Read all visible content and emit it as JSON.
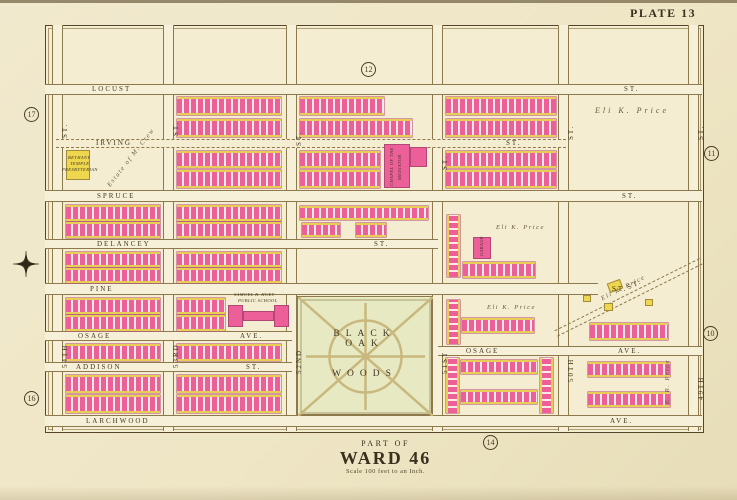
{
  "plate": {
    "label": "PLATE 13"
  },
  "caption": {
    "line1": "PART OF",
    "line2": "WARD 46",
    "line3": "Scale 100 feet to an Inch."
  },
  "colors": {
    "paper": "#efe7c8",
    "brick_pink": "#ec5f98",
    "frame_yellow": "#eed64f",
    "park_green": "#e7e9c3",
    "ink": "#4a3c22"
  },
  "map": {
    "park": {
      "label1": "BLACK OAK",
      "label2": "WOODS"
    },
    "v_streets": [
      {
        "name": "54th",
        "x": 52,
        "y1": 25,
        "y2": 431,
        "labels": [
          {
            "t": "ST.",
            "y": 138
          },
          {
            "t": "54TH",
            "y": 368
          }
        ]
      },
      {
        "name": "53rd",
        "x": 163,
        "y1": 25,
        "y2": 431,
        "labels": [
          {
            "t": "ST.",
            "y": 136
          },
          {
            "t": "53RD",
            "y": 368
          }
        ]
      },
      {
        "name": "52nd",
        "x": 286,
        "y1": 25,
        "y2": 431,
        "labels": [
          {
            "t": "ST.",
            "y": 146
          },
          {
            "t": "52ND",
            "y": 374
          }
        ]
      },
      {
        "name": "51st",
        "x": 432,
        "y1": 25,
        "y2": 431,
        "labels": [
          {
            "t": "ST.",
            "y": 170
          },
          {
            "t": "51ST",
            "y": 374
          }
        ]
      },
      {
        "name": "50th",
        "x": 558,
        "y1": 25,
        "y2": 431,
        "labels": [
          {
            "t": "ST.",
            "y": 140
          },
          {
            "t": "50TH",
            "y": 382
          }
        ]
      },
      {
        "name": "49th",
        "x": 688,
        "y1": 25,
        "y2": 431,
        "labels": [
          {
            "t": "ST.",
            "y": 140
          },
          {
            "t": "49TH",
            "y": 400
          }
        ]
      }
    ],
    "h_streets": [
      {
        "name": "locust",
        "y": 84,
        "h": 11,
        "x1": 45,
        "x2": 702,
        "labels": [
          {
            "t": "LOCUST",
            "x": 92
          },
          {
            "t": "ST.",
            "x": 624
          }
        ]
      },
      {
        "name": "irving",
        "y": 139,
        "h": 9,
        "x1": 56,
        "x2": 566,
        "dashed": true,
        "labels": [
          {
            "t": "IRVING",
            "x": 96
          },
          {
            "t": "ST.",
            "x": 506
          }
        ]
      },
      {
        "name": "spruce",
        "y": 190,
        "h": 12,
        "x1": 45,
        "x2": 702,
        "labels": [
          {
            "t": "SPRUCE",
            "x": 97
          },
          {
            "t": "ST.",
            "x": 622
          }
        ]
      },
      {
        "name": "delancey",
        "y": 239,
        "h": 10,
        "x1": 45,
        "x2": 438,
        "labels": [
          {
            "t": "DELANCEY",
            "x": 97
          },
          {
            "t": "ST.",
            "x": 374
          }
        ]
      },
      {
        "name": "pine",
        "y": 283,
        "h": 12,
        "x1": 45,
        "x2": 598,
        "labels": [
          {
            "t": "PINE",
            "x": 90
          },
          {
            "t": "ST.",
            "x": 612
          }
        ]
      },
      {
        "name": "osage-west",
        "y": 331,
        "h": 10,
        "x1": 45,
        "x2": 292,
        "labels": [
          {
            "t": "OSAGE",
            "x": 78
          },
          {
            "t": "AVE.",
            "x": 240
          }
        ]
      },
      {
        "name": "addison",
        "y": 362,
        "h": 10,
        "x1": 45,
        "x2": 292,
        "labels": [
          {
            "t": "ADDISON",
            "x": 76
          },
          {
            "t": "ST.",
            "x": 246
          }
        ]
      },
      {
        "name": "osage-east",
        "y": 346,
        "h": 10,
        "x1": 438,
        "x2": 702,
        "labels": [
          {
            "t": "OSAGE",
            "x": 466
          },
          {
            "t": "AVE.",
            "x": 618
          }
        ]
      },
      {
        "name": "larchwood",
        "y": 415,
        "h": 12,
        "x1": 45,
        "x2": 702,
        "labels": [
          {
            "t": "LARCHWOOD",
            "x": 86
          },
          {
            "t": "AVE.",
            "x": 610
          }
        ]
      }
    ],
    "diagonal_street": {
      "x": 556,
      "y": 330,
      "len": 162,
      "angle": -26.5
    },
    "house_rows": [
      [
        177,
        97,
        104,
        18,
        "h"
      ],
      [
        177,
        119,
        104,
        18,
        "h"
      ],
      [
        177,
        151,
        104,
        17,
        "h"
      ],
      [
        177,
        170,
        104,
        18,
        "h"
      ],
      [
        300,
        97,
        84,
        18,
        "h"
      ],
      [
        300,
        119,
        112,
        18,
        "h"
      ],
      [
        300,
        151,
        80,
        17,
        "h"
      ],
      [
        300,
        170,
        80,
        18,
        "h"
      ],
      [
        446,
        97,
        110,
        18,
        "h"
      ],
      [
        446,
        119,
        110,
        18,
        "h"
      ],
      [
        446,
        151,
        110,
        17,
        "h"
      ],
      [
        446,
        170,
        110,
        18,
        "h"
      ],
      [
        66,
        205,
        94,
        16,
        "h"
      ],
      [
        66,
        222,
        94,
        16,
        "h"
      ],
      [
        177,
        205,
        104,
        16,
        "h"
      ],
      [
        177,
        222,
        104,
        16,
        "h"
      ],
      [
        300,
        206,
        128,
        14,
        "h"
      ],
      [
        302,
        223,
        38,
        14,
        "h"
      ],
      [
        356,
        223,
        30,
        14,
        "h"
      ],
      [
        66,
        252,
        94,
        15,
        "h"
      ],
      [
        66,
        268,
        94,
        15,
        "h"
      ],
      [
        177,
        252,
        104,
        15,
        "h"
      ],
      [
        177,
        268,
        104,
        15,
        "h"
      ],
      [
        463,
        262,
        72,
        16,
        "h"
      ],
      [
        447,
        215,
        13,
        62,
        "v"
      ],
      [
        66,
        298,
        94,
        16,
        "h"
      ],
      [
        66,
        315,
        94,
        16,
        "h"
      ],
      [
        177,
        298,
        48,
        16,
        "h"
      ],
      [
        177,
        315,
        48,
        16,
        "h"
      ],
      [
        447,
        300,
        13,
        44,
        "v"
      ],
      [
        462,
        318,
        72,
        15,
        "h"
      ],
      [
        590,
        323,
        78,
        17,
        "h"
      ],
      [
        66,
        344,
        94,
        17,
        "h"
      ],
      [
        177,
        344,
        104,
        17,
        "h"
      ],
      [
        66,
        375,
        94,
        18,
        "h"
      ],
      [
        66,
        395,
        94,
        18,
        "h"
      ],
      [
        177,
        375,
        104,
        18,
        "h"
      ],
      [
        177,
        395,
        104,
        18,
        "h"
      ],
      [
        446,
        358,
        13,
        55,
        "v"
      ],
      [
        540,
        358,
        13,
        55,
        "v"
      ],
      [
        461,
        360,
        76,
        14,
        "h"
      ],
      [
        461,
        390,
        76,
        14,
        "h"
      ],
      [
        588,
        362,
        82,
        15,
        "h"
      ],
      [
        588,
        392,
        82,
        15,
        "h"
      ]
    ],
    "buildings": [
      {
        "x": 66,
        "y": 150,
        "w": 24,
        "h": 30,
        "c": "yellow",
        "label": "bethany-temple"
      },
      {
        "x": 384,
        "y": 144,
        "w": 26,
        "h": 44,
        "c": "pink",
        "label": "chapel-of-the-mediator"
      },
      {
        "x": 410,
        "y": 147,
        "w": 17,
        "h": 20,
        "c": "pink"
      },
      {
        "x": 228,
        "y": 305,
        "w": 15,
        "h": 22,
        "c": "pink",
        "label": "huey-school-west-wing"
      },
      {
        "x": 274,
        "y": 305,
        "w": 15,
        "h": 22,
        "c": "pink",
        "label": "huey-school-east-wing"
      },
      {
        "x": 243,
        "y": 311,
        "w": 31,
        "h": 10,
        "c": "pink",
        "label": "huey-school-center"
      },
      {
        "x": 473,
        "y": 237,
        "w": 18,
        "h": 22,
        "c": "pink",
        "label": "garage"
      },
      {
        "x": 608,
        "y": 281,
        "w": 14,
        "h": 10,
        "c": "yellow",
        "rot": -20
      },
      {
        "x": 604,
        "y": 303,
        "w": 9,
        "h": 8,
        "c": "yellow"
      },
      {
        "x": 583,
        "y": 295,
        "w": 8,
        "h": 7,
        "c": "yellow"
      },
      {
        "x": 645,
        "y": 299,
        "w": 8,
        "h": 7,
        "c": "yellow"
      }
    ],
    "labels": [
      {
        "t": "Eli K. Price",
        "x": 595,
        "y": 106,
        "cls": "estate"
      },
      {
        "t": "Eli K. Price",
        "x": 496,
        "y": 224,
        "cls": "estate-sm"
      },
      {
        "t": "Eli K. Price",
        "x": 487,
        "y": 304,
        "cls": "estate-sm"
      },
      {
        "t": "Eli K. Price",
        "x": 600,
        "y": 296,
        "cls": "estate-sm",
        "rot": -27
      },
      {
        "t": "ST.",
        "x": 626,
        "y": 284,
        "cls": "slabel2",
        "rot": -26.5
      },
      {
        "t": "E. R. Price",
        "x": 664,
        "y": 404,
        "cls": "estate-sm",
        "rot": -90
      },
      {
        "t": "Estate of M. Crew",
        "x": 106,
        "y": 184,
        "cls": "estate-sm",
        "rot": -52
      },
      {
        "t": "SAMUEL B. HUEY",
        "x": 234,
        "y": 292,
        "cls": "tiny"
      },
      {
        "t": "PUBLIC SCHOOL",
        "x": 238,
        "y": 298,
        "cls": "tiny"
      },
      {
        "t": "BETHANY",
        "x": 68,
        "y": 155,
        "cls": "tiny"
      },
      {
        "t": "TEMPLE",
        "x": 70,
        "y": 161,
        "cls": "tiny"
      },
      {
        "t": "PRESBYTERIAN",
        "x": 62,
        "y": 167,
        "cls": "tiny"
      },
      {
        "t": "CHAPEL OF THE",
        "x": 389,
        "y": 186,
        "cls": "tiny",
        "rot": -90
      },
      {
        "t": "MEDIATOR",
        "x": 397,
        "y": 180,
        "cls": "tiny",
        "rot": -90
      },
      {
        "t": "GARAGE",
        "x": 479,
        "y": 256,
        "cls": "tiny",
        "rot": -90
      }
    ],
    "plate_refs": [
      {
        "n": "17",
        "x": 24,
        "y": 107
      },
      {
        "n": "16",
        "x": 24,
        "y": 391
      },
      {
        "n": "12",
        "x": 361,
        "y": 62
      },
      {
        "n": "14",
        "x": 483,
        "y": 435
      },
      {
        "n": "11",
        "x": 704,
        "y": 146
      },
      {
        "n": "10",
        "x": 703,
        "y": 326
      }
    ]
  }
}
